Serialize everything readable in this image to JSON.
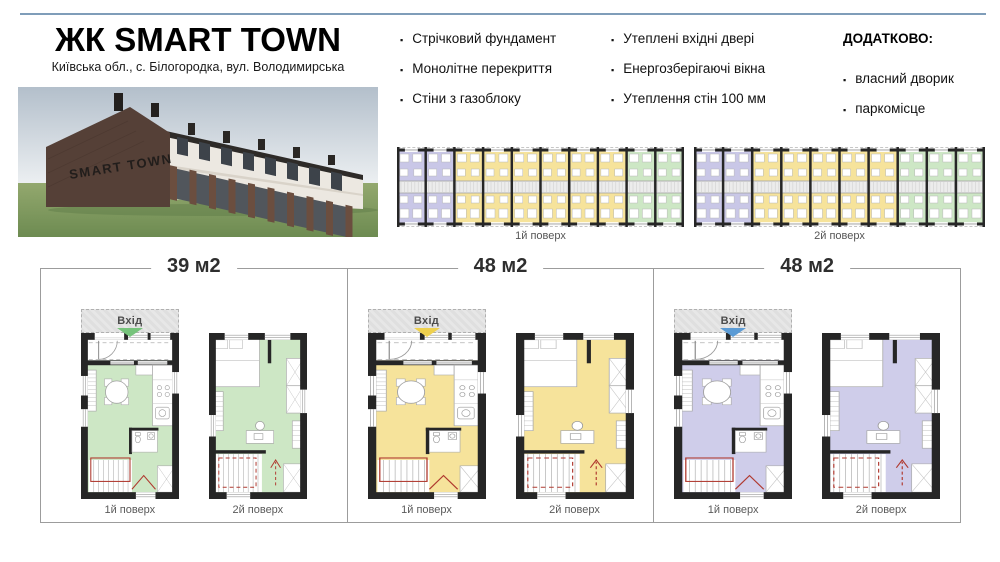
{
  "colors": {
    "accent": "#7f9db9",
    "purple": "#c9c7e7",
    "yellow": "#f6e39b",
    "green": "#cde7c5",
    "wall": "#262626",
    "red": "#b03a30",
    "entry": "#e7e7e7"
  },
  "header": {
    "title": "ЖК SMART TOWN",
    "subtitle": "Київська обл., с. Білогородка, вул. Володимирська"
  },
  "photo": {
    "sign": "SMART TOWN"
  },
  "features": {
    "col1": [
      "Стрічковий фундамент",
      "Монолітне перекриття",
      "Стіни з газоблоку"
    ],
    "col2": [
      "Утеплені вхідні двері",
      "Енергозберігаючі вікна",
      "Утеплення стін 100 мм"
    ]
  },
  "additional": {
    "heading": "ДОДАТКОВО:",
    "items": [
      "власний дворик",
      "паркомісце"
    ]
  },
  "site_plans": [
    {
      "label": "1й поверх",
      "cells": [
        "purple",
        "purple",
        "yellow",
        "yellow",
        "yellow",
        "yellow",
        "yellow",
        "yellow",
        "green",
        "green"
      ]
    },
    {
      "label": "2й поверх",
      "cells": [
        "purple",
        "purple",
        "yellow",
        "yellow",
        "yellow",
        "yellow",
        "yellow",
        "green",
        "green",
        "green"
      ]
    }
  ],
  "units": [
    {
      "area": "39 м2",
      "entrance": "Вхід",
      "floor1_label": "1й поверх",
      "floor2_label": "2й поверх",
      "color": "#cde7c5",
      "arrow": "#76c37b"
    },
    {
      "area": "48 м2",
      "entrance": "Вхід",
      "floor1_label": "1й поверх",
      "floor2_label": "2й поверх",
      "color": "#f6e39b",
      "arrow": "#eed04e"
    },
    {
      "area": "48 м2",
      "entrance": "Вхід",
      "floor1_label": "1й поверх",
      "floor2_label": "2й поверх",
      "color": "#cfcdea",
      "arrow": "#5b9bd5"
    }
  ]
}
